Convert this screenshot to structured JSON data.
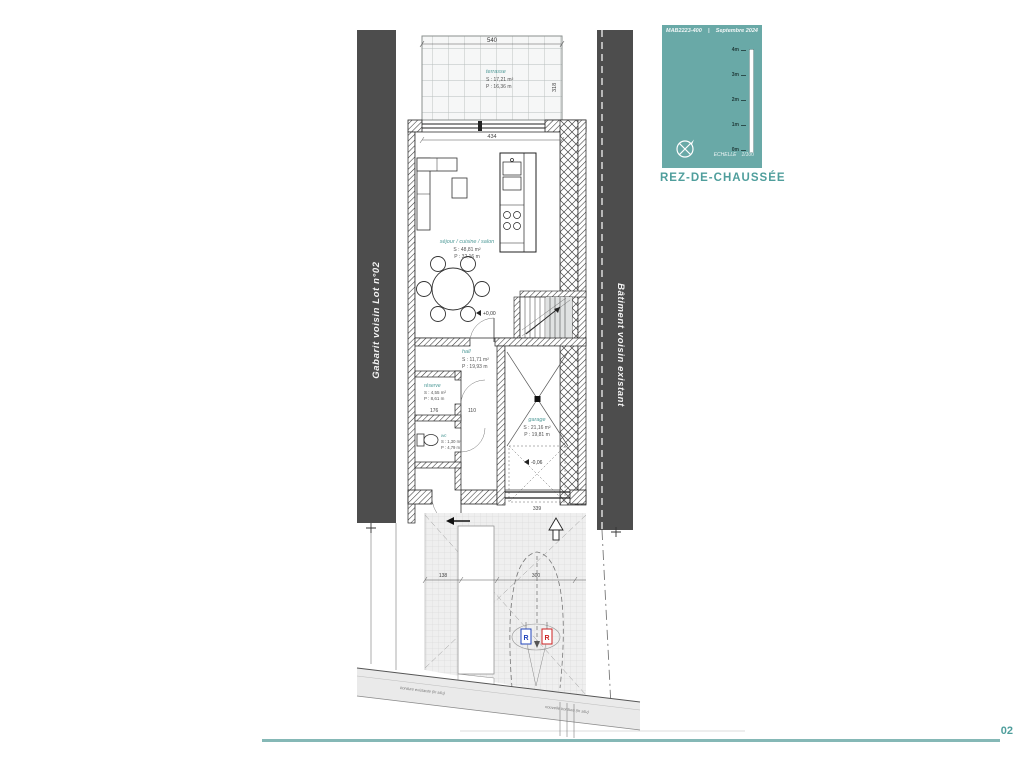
{
  "titleblock": {
    "ref": "MAB2223-400",
    "sep": "|",
    "date": "Septembre 2024",
    "ticks": [
      "4m",
      "3m",
      "2m",
      "1m",
      "0m"
    ],
    "scale_label": "ECHELLE",
    "scale_value": "1/100",
    "drawing_title": "REZ-DE-CHAUSSÉE",
    "accent_color": "#69a9a7"
  },
  "context": {
    "left_label": "Gabarit voisin Lot n°02",
    "right_label": "Bâtiment voisin existant"
  },
  "rooms": {
    "terrasse": {
      "name": "terrasse",
      "area": "S : 17,21 m²",
      "perim": "P : 16,36 m"
    },
    "sejour": {
      "name": "séjour / cuisine / salon",
      "area": "S : 48,81 m²",
      "perim": "P : 32,16 m"
    },
    "hall": {
      "name": "hall",
      "area": "S : 11,71 m²",
      "perim": "P : 19,93 m"
    },
    "reserve": {
      "name": "réserve",
      "area": "S : 4,55 m²",
      "perim": "P : 8,61 m"
    },
    "wc": {
      "name": "wc",
      "area": "S : 1,30 m²",
      "perim": "P : 4,79 m"
    },
    "garage": {
      "name": "garage",
      "area": "S : 21,16 m²",
      "perim": "P : 19,81 m"
    }
  },
  "levels": {
    "ground": "+0,00",
    "garage": "-0,06"
  },
  "dims": {
    "terrace_w": "540",
    "terrace_d": "318",
    "living_w": "434",
    "reserve_w": "176",
    "wc_w": "110",
    "walk_w": "138",
    "drive_w": "300",
    "garage_door_w": "339"
  },
  "markers": {
    "r1": "R",
    "r2": "R"
  },
  "street": {
    "note1": "bordure existante (in situ)",
    "note2": "nouvelle bordure (in situ)"
  },
  "footer": {
    "page": "02"
  }
}
